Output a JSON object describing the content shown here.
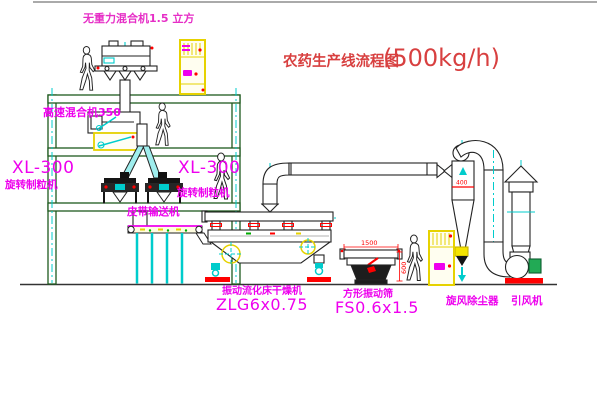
{
  "title": {
    "name": "农药生产线流程图",
    "capacity": "(500kg/h)"
  },
  "labels": {
    "gravity_mixer": "无重力混合机1.5 立方",
    "high_speed_mixer": "高速混合机350",
    "granulator_left_model": "XL-300",
    "granulator_left_name": "旋转制粒机",
    "granulator_right_model": "XL-300",
    "granulator_right_name": "旋转制粒机",
    "belt_conveyor": "皮带输送机",
    "dryer_name": "振动流化床干燥机",
    "dryer_model": "ZLG6x0.75",
    "sieve_name": "方形振动筛",
    "sieve_model": "FS0.6x1.5",
    "cyclone": "旋风除尘器",
    "fan": "引风机"
  },
  "dimensions": {
    "sieve_length": "1500",
    "sieve_height": "600",
    "cyclone_diameter": "400"
  },
  "colors": {
    "label_magenta": "#ee00ee",
    "top_label_pink": "#e62ec6",
    "title_red": "#d84040",
    "structure_green": "#1e5a1e",
    "centerline_cyan": "#00cccc",
    "equipment_yellow": "#e6d200",
    "accent_red": "#ff0000",
    "motor_green": "#22aa55"
  }
}
